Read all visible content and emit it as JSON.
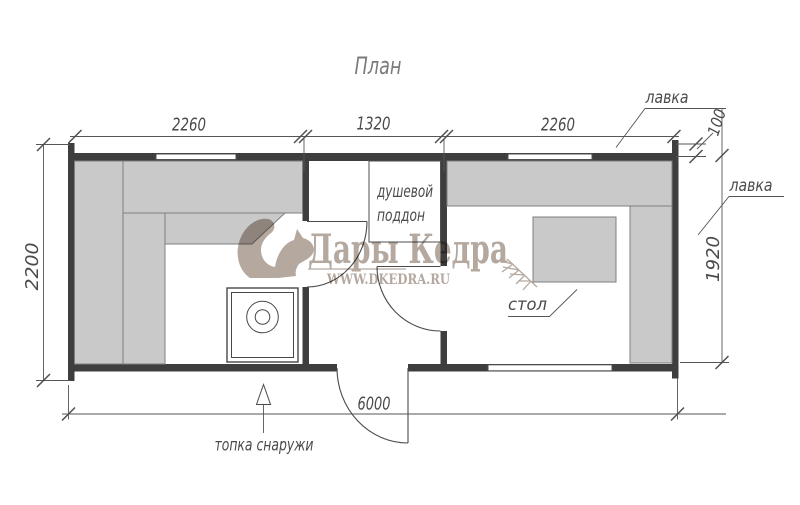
{
  "title": "План",
  "dimensions": {
    "left_room_width": "2260",
    "shower_room_width": "1320",
    "rest_room_width": "2260",
    "building_depth": "2200",
    "rest_room_depth": "1920",
    "wall_offset": "100",
    "building_length": "6000"
  },
  "labels": {
    "bench_top": "лавка",
    "bench_side": "лавка",
    "shower_tray_line1": "душевой",
    "shower_tray_line2": "поддон",
    "table": "стол",
    "furnace_note": "топка снаружи"
  },
  "watermark": {
    "brand": "Дары Кедра",
    "url": "WWW.DKEDRA.RU"
  },
  "colors": {
    "wall": "#3e3e3e",
    "bench_fill": "#c9c9c9",
    "bench_stroke": "#7f7f7f",
    "line": "#4f4f4f",
    "text": "#4a4a4a",
    "watermark": "#a3958a"
  }
}
